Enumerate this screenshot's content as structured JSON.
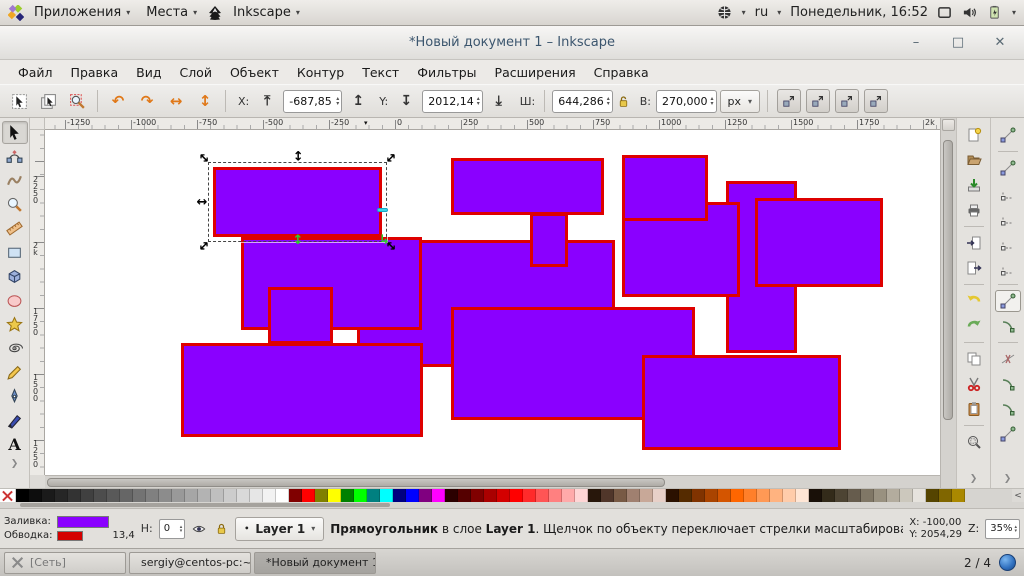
{
  "desktop_panel": {
    "applications": "Приложения",
    "places": "Места",
    "app_menu": "Inkscape",
    "keyboard_layout": "ru",
    "clock": "Понедельник, 16:52",
    "icons": [
      "distro-logo-icon",
      "inkscape-logo-icon",
      "globe-icon",
      "keyboard-caret",
      "display-icon",
      "volume-icon",
      "battery-icon"
    ]
  },
  "window": {
    "title": "*Новый документ 1 – Inkscape",
    "controls": [
      {
        "name": "minimize-button",
        "glyph": "–"
      },
      {
        "name": "maximize-button",
        "glyph": "□"
      },
      {
        "name": "close-button",
        "glyph": "✕"
      }
    ]
  },
  "menu": {
    "items": [
      "Файл",
      "Правка",
      "Вид",
      "Слой",
      "Объект",
      "Контур",
      "Текст",
      "Фильтры",
      "Расширения",
      "Справка"
    ]
  },
  "toolbar": {
    "select_buttons": [
      "select-all",
      "select-all-layers",
      "zoom-selection"
    ],
    "transform_buttons": [
      {
        "name": "rotate-ccw",
        "glyph": "↶"
      },
      {
        "name": "rotate-cw",
        "glyph": "↷"
      },
      {
        "name": "flip-horizontal",
        "glyph": "↔"
      },
      {
        "name": "flip-vertical",
        "glyph": "↕"
      }
    ],
    "zorder_buttons": [
      {
        "name": "raise-to-top",
        "glyph": "⤒"
      },
      {
        "name": "raise",
        "glyph": "↥"
      },
      {
        "name": "lower",
        "glyph": "↧"
      },
      {
        "name": "lower-to-bottom",
        "glyph": "⤓"
      }
    ],
    "x_label": "X:",
    "x_value": "-687,85",
    "y_label": "Y:",
    "y_value": "2012,14",
    "w_label": "Ш:",
    "w_value": "644,286",
    "h_label": "В:",
    "h_value": "270,000",
    "lock_icon": "lock-ratio-icon",
    "units": "px",
    "affect_buttons": [
      "move-patterns",
      "move-gradients",
      "move-clips",
      "transform-stroke"
    ]
  },
  "rulers": {
    "horizontal": [
      {
        "label": "-1250",
        "pos": 20
      },
      {
        "label": "-1000",
        "pos": 86
      },
      {
        "label": "-750",
        "pos": 152
      },
      {
        "label": "-500",
        "pos": 218
      },
      {
        "label": "-250",
        "pos": 284
      },
      {
        "label": "0",
        "pos": 350
      },
      {
        "label": "250",
        "pos": 416
      },
      {
        "label": "500",
        "pos": 482
      },
      {
        "label": "750",
        "pos": 548
      },
      {
        "label": "1000",
        "pos": 614
      },
      {
        "label": "1250",
        "pos": 680
      },
      {
        "label": "1500",
        "pos": 746
      },
      {
        "label": "1750",
        "pos": 812
      },
      {
        "label": "2k",
        "pos": 878
      }
    ],
    "marker_pos": 319,
    "vertical": [
      {
        "label": "2250",
        "pos": 46
      },
      {
        "label": "2k",
        "pos": 112
      },
      {
        "label": "1750",
        "pos": 178
      },
      {
        "label": "1500",
        "pos": 244
      },
      {
        "label": "1250",
        "pos": 310
      }
    ]
  },
  "canvas": {
    "fill_color": "#8a00ff",
    "stroke_color": "#de0000",
    "rects": [
      {
        "x": 312,
        "y": 110,
        "w": 258,
        "h": 127
      },
      {
        "x": 196,
        "y": 107,
        "w": 181,
        "h": 93
      },
      {
        "x": 681,
        "y": 51,
        "w": 71,
        "h": 172
      },
      {
        "x": 577,
        "y": 72,
        "w": 118,
        "h": 95
      },
      {
        "x": 406,
        "y": 28,
        "w": 153,
        "h": 57
      },
      {
        "x": 485,
        "y": 83,
        "w": 38,
        "h": 54
      },
      {
        "x": 577,
        "y": 25,
        "w": 86,
        "h": 66
      },
      {
        "x": 710,
        "y": 68,
        "w": 128,
        "h": 89
      },
      {
        "x": 136,
        "y": 213,
        "w": 242,
        "h": 94
      },
      {
        "x": 223,
        "y": 157,
        "w": 65,
        "h": 57
      },
      {
        "x": 406,
        "y": 177,
        "w": 244,
        "h": 113
      },
      {
        "x": 597,
        "y": 225,
        "w": 199,
        "h": 95
      }
    ],
    "selected": {
      "x": 168,
      "y": 37,
      "w": 169,
      "h": 70
    }
  },
  "toolbox": {
    "tools": [
      "select",
      "node",
      "tweak",
      "zoom",
      "measure",
      "rectangle",
      "box3d",
      "ellipse",
      "star",
      "spiral",
      "pencil",
      "pen",
      "calligraphy",
      "text"
    ],
    "selected_index": 0
  },
  "commands": {
    "items": [
      "new-document",
      "open",
      "save",
      "print",
      "import",
      "export",
      "undo",
      "redo",
      "copy",
      "cut",
      "paste",
      "zoom-drawing"
    ],
    "separators_after": [
      3,
      5,
      7,
      10
    ]
  },
  "snapbar": {
    "items": [
      "snap-toggle",
      "snap-bbox",
      "snap-bbox-edge",
      "snap-bbox-corner",
      "snap-bbox-edge-mid",
      "snap-bbox-center",
      "snap-nodes",
      "snap-path",
      "snap-intersection",
      "snap-cusp-node",
      "snap-smooth-node",
      "snap-midpoint"
    ],
    "active_index": 6,
    "separators_after": [
      0,
      5,
      7
    ]
  },
  "palette": {
    "colors": [
      "#000000",
      "#0d0d0d",
      "#1a1a1a",
      "#262626",
      "#333333",
      "#404040",
      "#4d4d4d",
      "#595959",
      "#666666",
      "#737373",
      "#808080",
      "#8c8c8c",
      "#999999",
      "#a6a6a6",
      "#b3b3b3",
      "#bfbfbf",
      "#cccccc",
      "#d9d9d9",
      "#e6e6e6",
      "#f2f2f2",
      "#ffffff",
      "#800000",
      "#ff0000",
      "#808000",
      "#ffff00",
      "#008000",
      "#00ff00",
      "#008080",
      "#00ffff",
      "#000080",
      "#0000ff",
      "#800080",
      "#ff00ff",
      "#2b0000",
      "#550000",
      "#800000",
      "#aa0000",
      "#d40000",
      "#ff0000",
      "#ff2a2a",
      "#ff5555",
      "#ff8080",
      "#ffaaaa",
      "#ffd5d5",
      "#28170b",
      "#50362a",
      "#785a45",
      "#a08070",
      "#c8a898",
      "#e8d0c8",
      "#2b1100",
      "#552b00",
      "#803300",
      "#aa4400",
      "#d45500",
      "#ff6600",
      "#ff7f2a",
      "#ff9955",
      "#ffb380",
      "#ffccaa",
      "#ffe6d5",
      "#191008",
      "#332b1a",
      "#4d4433",
      "#665c4d",
      "#807766",
      "#999180",
      "#b3ac9e",
      "#ccc8bd",
      "#e6e3dd",
      "#554400",
      "#806600",
      "#aa8800"
    ],
    "scroll_arrow": "<"
  },
  "statusbar": {
    "fill_label": "Заливка:",
    "stroke_label": "Обводка:",
    "fill_color": "#8a00ff",
    "stroke_color": "#d40000",
    "stroke_width": "13,4",
    "opacity_label": "H:",
    "opacity_value": "0",
    "layer_name": "Layer 1",
    "message_object": "Прямоугольник",
    "message_mid": " в слое ",
    "message_layer": "Layer 1",
    "message_rest": ". Щелчок по объекту переключает стрелки масштабирования/вращ…",
    "cursor_x": "X: -100,00",
    "cursor_y": "Y: 2054,29",
    "zoom_label": "Z:",
    "zoom_value": "35%"
  },
  "taskbar": {
    "items": [
      {
        "label": "[Сеть]",
        "icon": "network-icon",
        "active": false,
        "dim": true
      },
      {
        "label": "sergiy@centos-pc:~",
        "icon": "terminal-icon",
        "active": false,
        "dim": false
      },
      {
        "label": "*Новый документ 1 – Inkscape",
        "icon": "inkscape-logo-icon",
        "active": true,
        "dim": false
      }
    ],
    "pager": "2 / 4"
  }
}
